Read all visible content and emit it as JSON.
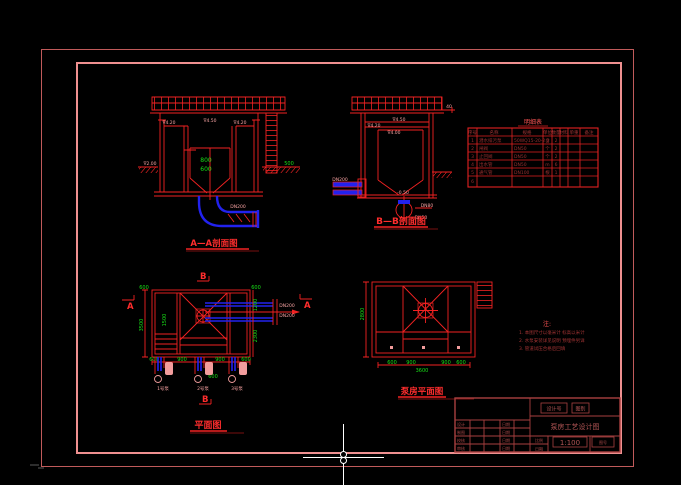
{
  "app": {
    "background": "#000000"
  },
  "colors": {
    "line_red": "#f22222",
    "pink_text": "#f7a2a2",
    "green_text": "#17e017",
    "pipe_blue": "#2222ee",
    "frame_outer": "#c05a5a",
    "frame_inner": "#ef9090",
    "crosshair": "#ffffff",
    "table_text": "#993030"
  },
  "labels": {
    "section_aa": "A—A剖面图",
    "section_bb": "B—B剖面图",
    "plan": "平面图",
    "roof_plan": "泵房平面图"
  },
  "parts_table": {
    "title": "明细表",
    "headers": [
      "序号",
      "名称",
      "规格",
      "单位",
      "数量",
      "材料",
      "单重",
      "备注"
    ],
    "rows": [
      [
        "1",
        "潜水排污泵",
        "50WQ15-20-2.2",
        "台",
        "2"
      ],
      [
        "2",
        "闸阀",
        "DN50",
        "个",
        "2"
      ],
      [
        "3",
        "止回阀",
        "DN50",
        "个",
        "2"
      ],
      [
        "4",
        "出水管",
        "DN50",
        "m",
        "6"
      ],
      [
        "5",
        "通气管",
        "DN100",
        "根",
        "1"
      ],
      [
        "6"
      ]
    ]
  },
  "notes": {
    "title": "注:",
    "lines": [
      "1. 本图尺寸以毫米计 标高以米计",
      "2. 水泵安装详见说明 预埋件另详",
      "3. 管道试压合格后回填"
    ]
  },
  "title_block": {
    "field1": "设计号",
    "field2": "图别",
    "drawing_title": "泵房工艺设计图",
    "scale_label": "比例",
    "scale": "1:100",
    "no_label": "图号",
    "date_label": "日期",
    "sig_labels": [
      "设计",
      "制图",
      "校核",
      "审核"
    ],
    "sig_dates": [
      "日期",
      "日期",
      "日期",
      "日期"
    ]
  },
  "dims": {
    "aa_pink": [
      "∇4.50",
      "∇4.20",
      "∇4.20",
      "∇2.00",
      "DN200"
    ],
    "aa_green": [
      "800",
      "600",
      "500"
    ],
    "bb_pink": [
      "∇4.50",
      "∇4.20",
      "∇4.00",
      "DN200",
      "-0.50",
      "DN80",
      "DN50",
      "40"
    ],
    "plan_green": [
      "600",
      "600",
      "1200",
      "2300",
      "3500",
      "1500",
      "600",
      "900",
      "900",
      "600",
      "600"
    ],
    "plan_pink": [
      "DN200",
      "DN200"
    ],
    "plan_markers": {
      "a": "A",
      "b": "B"
    },
    "roof_green": [
      "600",
      "900",
      "900",
      "600",
      "3600",
      "2800"
    ],
    "pump_labels": [
      "1号泵",
      "2号泵",
      "3号泵"
    ]
  }
}
